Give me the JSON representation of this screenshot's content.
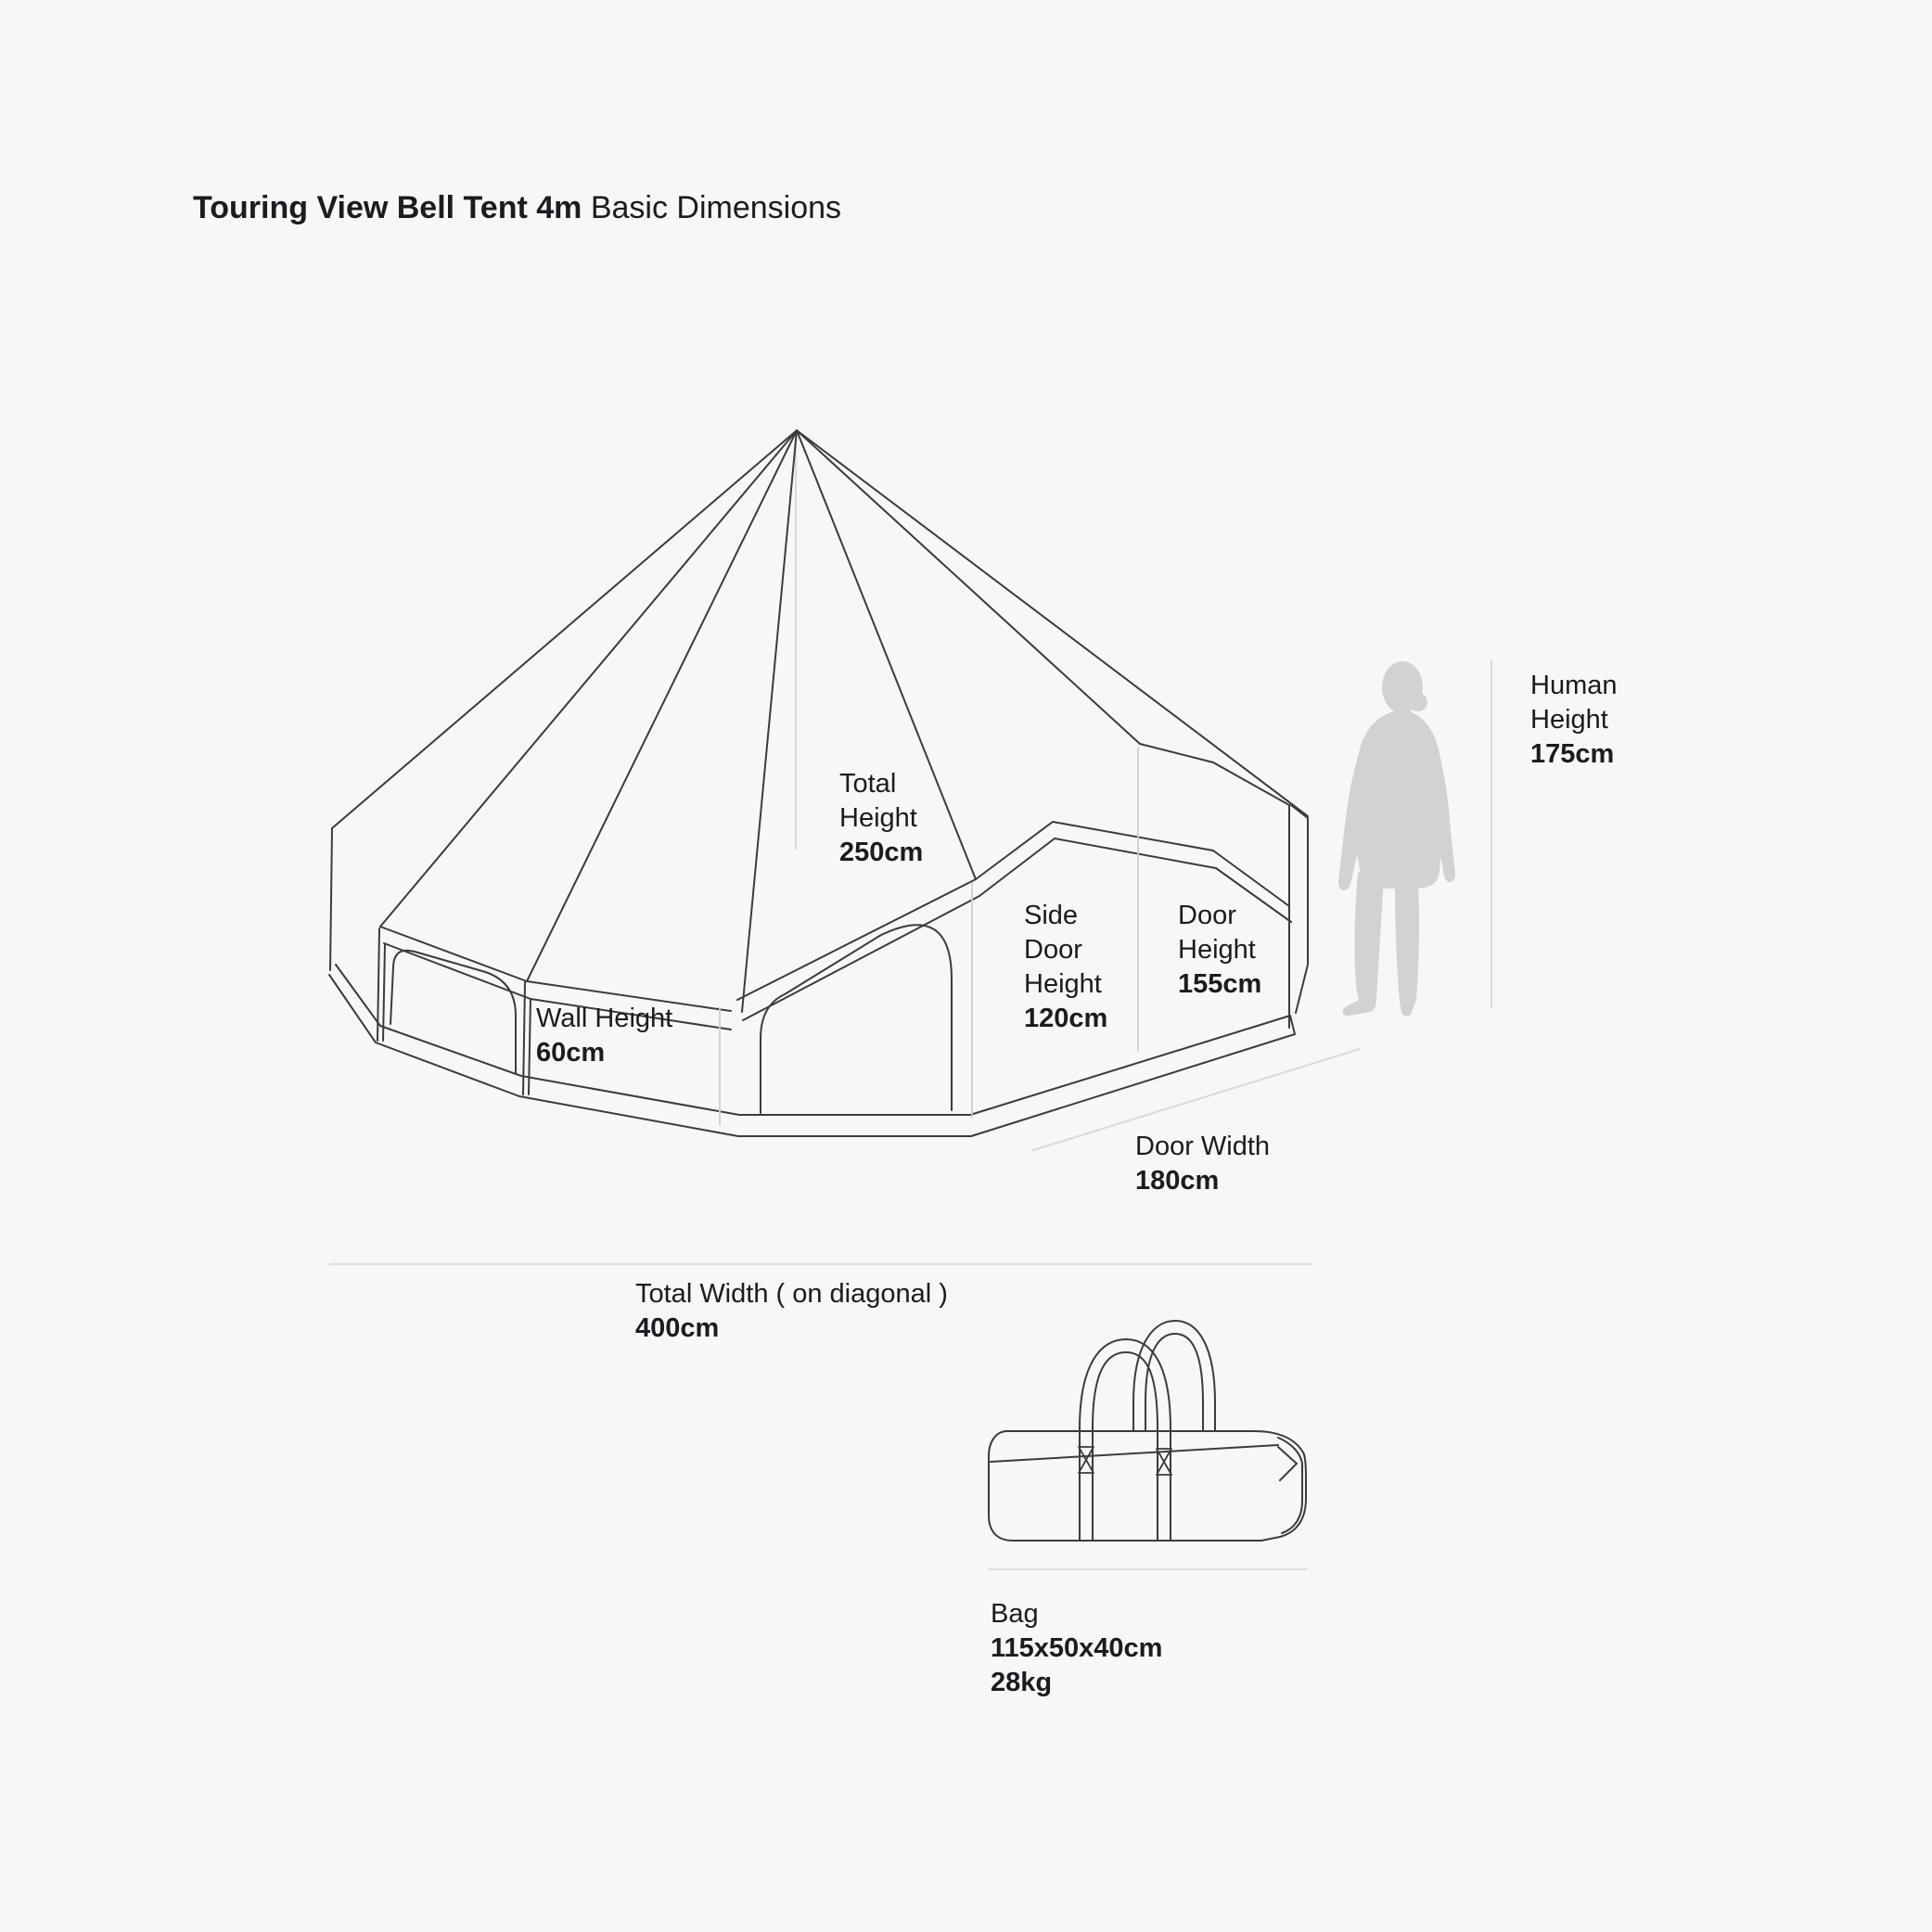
{
  "title": {
    "bold": "Touring View Bell Tent 4m",
    "regular": "Basic Dimensions"
  },
  "dimensions": {
    "total_height": {
      "lines": [
        "Total",
        "Height"
      ],
      "value": "250cm"
    },
    "wall_height": {
      "lines": [
        "Wall Height"
      ],
      "value": "60cm"
    },
    "side_door_height": {
      "lines": [
        "Side",
        "Door",
        "Height"
      ],
      "value": "120cm"
    },
    "door_height": {
      "lines": [
        "Door",
        "Height"
      ],
      "value": "155cm"
    },
    "door_width": {
      "lines": [
        "Door Width"
      ],
      "value": "180cm"
    },
    "total_width": {
      "lines": [
        "Total Width ( on diagonal )"
      ],
      "value": "400cm"
    },
    "human_height": {
      "lines": [
        "Human",
        "Height"
      ],
      "value": "175cm"
    },
    "bag": {
      "label": "Bag",
      "size": "115x50x40cm",
      "weight": "28kg"
    }
  },
  "illustrations": {
    "tent": "bell-tent-line-drawing",
    "human": "human-silhouette",
    "bag": "carry-bag-line-drawing"
  },
  "colors": {
    "background": "#f7f7f7",
    "line": "#3b3b41",
    "reference_line": "#d9d9dc",
    "silhouette": "#d2d2d4",
    "text": "#1b1b20"
  }
}
